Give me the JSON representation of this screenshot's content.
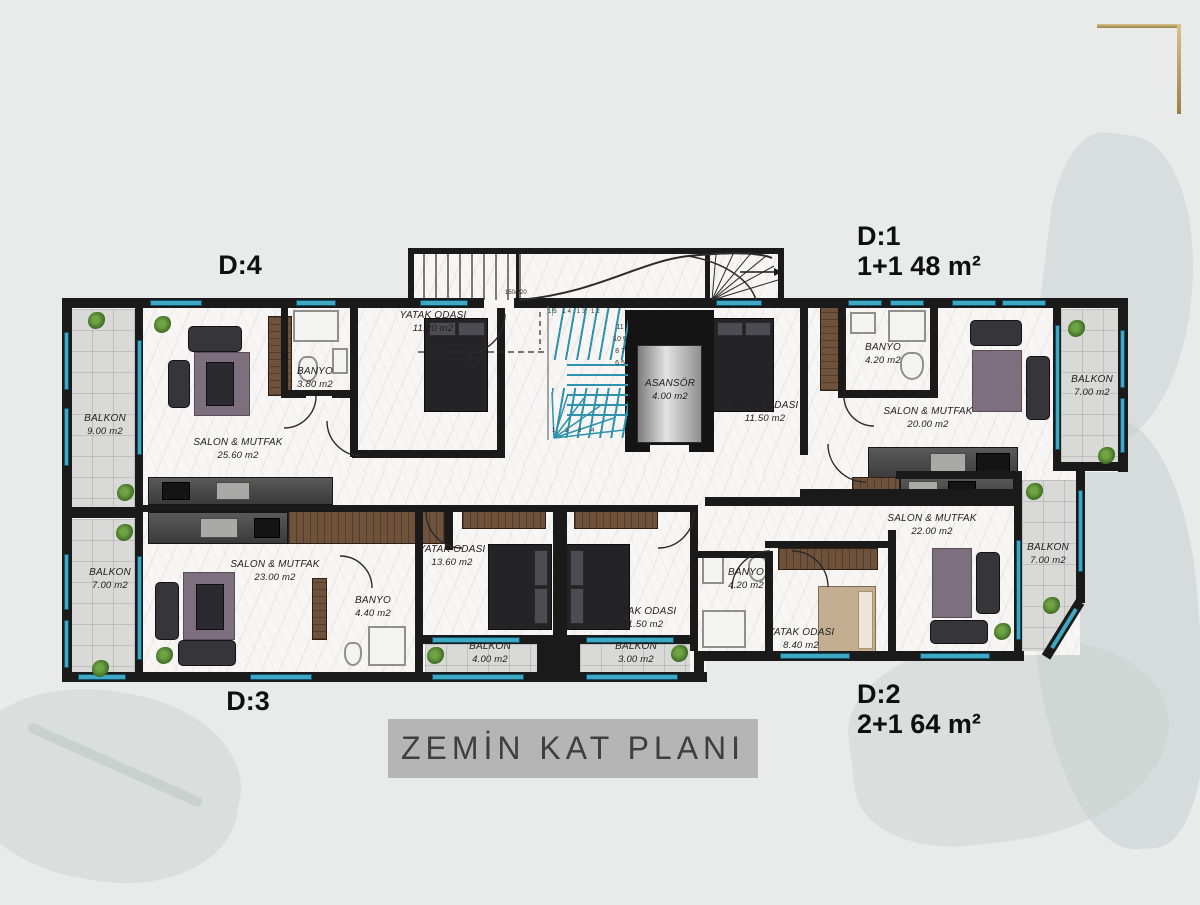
{
  "plan": {
    "title": "ZEMİN KAT PLANI",
    "units": [
      {
        "id": "D:4",
        "spec": ""
      },
      {
        "id": "D:1",
        "spec": "1+1 48 m²"
      },
      {
        "id": "D:3",
        "spec": ""
      },
      {
        "id": "D:2",
        "spec": "2+1 64 m²"
      }
    ],
    "rooms": [
      {
        "name": "BALKON",
        "area": "9.00 m2"
      },
      {
        "name": "SALON & MUTFAK",
        "area": "25.60 m2"
      },
      {
        "name": "BANYO",
        "area": "3.80 m2"
      },
      {
        "name": "YATAK ODASI",
        "area": "11.20 m2"
      },
      {
        "name": "ASANSÖR",
        "area": "4.00 m2"
      },
      {
        "name": "YATAK ODASI",
        "area": "11.50 m2"
      },
      {
        "name": "BANYO",
        "area": "4.20 m2"
      },
      {
        "name": "SALON & MUTFAK",
        "area": "20.00 m2"
      },
      {
        "name": "BALKON",
        "area": "7.00 m2"
      },
      {
        "name": "BALKON",
        "area": "7.00 m2"
      },
      {
        "name": "SALON & MUTFAK",
        "area": "23.00 m2"
      },
      {
        "name": "BANYO",
        "area": "4.40 m2"
      },
      {
        "name": "YATAK ODASI",
        "area": "13.60 m2"
      },
      {
        "name": "BALKON",
        "area": "4.00 m2"
      },
      {
        "name": "YATAK ODASI",
        "area": "11.50 m2"
      },
      {
        "name": "BALKON",
        "area": "3.00 m2"
      },
      {
        "name": "BANYO",
        "area": "4.20 m2"
      },
      {
        "name": "YATAK ODASI",
        "area": "8.40 m2"
      },
      {
        "name": "SALON & MUTFAK",
        "area": "22.00 m2"
      },
      {
        "name": "BALKON",
        "area": "7.00 m2"
      }
    ],
    "annotations": {
      "door_size": "150/220",
      "stair_top": "15 14 13 12",
      "stair_side": "11 10 9 8 7 6 5",
      "stair_bottom": "1 2 3 4"
    }
  },
  "colors": {
    "window_accent": "#3fa9c4",
    "wall": "#1a1a1a",
    "gold_bracket": "#b09552",
    "title_bar_bg": "#b4b5b4",
    "background": "#e9eaea"
  }
}
